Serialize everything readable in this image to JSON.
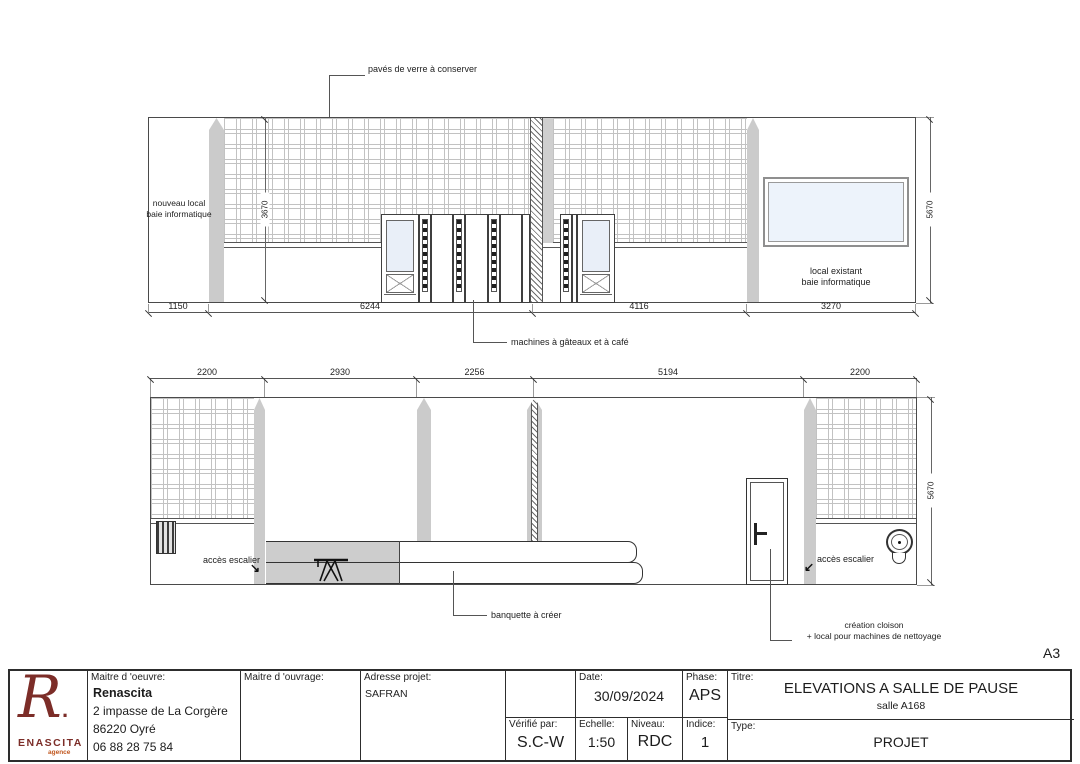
{
  "page": {
    "sheet_size_label": "A3"
  },
  "elevation1": {
    "annotations": {
      "paves": "pavés de verre à conserver",
      "nouveau_local_l1": "nouveau local",
      "nouveau_local_l2": "baie informatique",
      "machines": "machines à gâteaux et à café",
      "local_existant_l1": "local existant",
      "local_existant_l2": "baie informatique"
    },
    "dims_h": [
      "1150",
      "6244",
      "4116",
      "3270"
    ],
    "dim_v_left": "3670",
    "dim_v_right": "5670"
  },
  "elevation2": {
    "annotations": {
      "acces_left": "accès escalier",
      "acces_right": "accès escalier",
      "banquette": "banquette à créer",
      "cloison_l1": "création cloison",
      "cloison_l2": "+ local pour machines de nettoyage"
    },
    "dims_h": [
      "2200",
      "2930",
      "2256",
      "5194",
      "2200"
    ],
    "dim_v_right": "5670",
    "arrow_se": "↘",
    "arrow_sw": "↙"
  },
  "titleblock": {
    "logo": {
      "letter": "R",
      "dot": ".",
      "name": "ENASCITA",
      "sub": "agence",
      "color": "#7c2d28"
    },
    "maitre_oeuvre": {
      "label": "Maitre d 'oeuvre:",
      "name": "Renascita",
      "address1": "2 impasse de La Corgère",
      "address2": "86220 Oyré",
      "phone": "06 88 28 75 84"
    },
    "maitre_ouvrage": {
      "label": "Maitre d 'ouvrage:"
    },
    "adresse_projet": {
      "label": "Adresse projet:",
      "value": "SAFRAN"
    },
    "verifie": {
      "label": "Vérifié par:",
      "value": "S.C-W"
    },
    "date": {
      "label": "Date:",
      "value": "30/09/2024"
    },
    "echelle": {
      "label": "Echelle:",
      "value": "1:50"
    },
    "niveau": {
      "label": "Niveau:",
      "value": "RDC"
    },
    "phase": {
      "label": "Phase:",
      "value": "APS"
    },
    "indice": {
      "label": "Indice:",
      "value": "1"
    },
    "titre": {
      "label": "Titre:",
      "value": "ELEVATIONS A SALLE DE PAUSE",
      "sub": "salle A168"
    },
    "type": {
      "label": "Type:",
      "value": "PROJET"
    }
  }
}
